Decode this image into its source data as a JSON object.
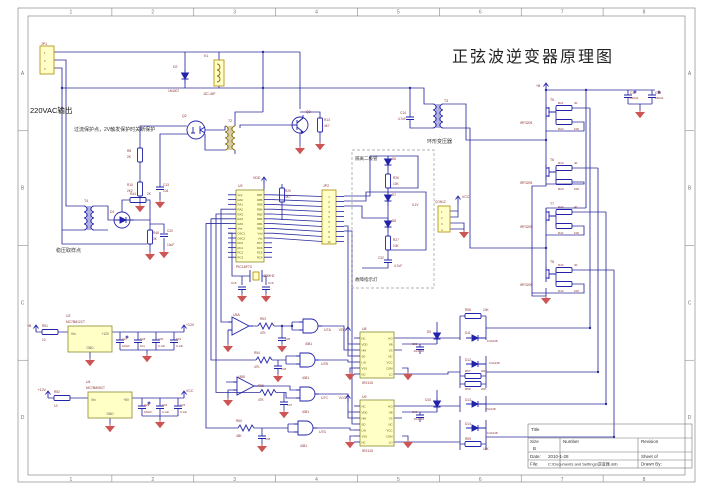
{
  "sheet": {
    "title": "正弦波逆变器原理图"
  },
  "grid": {
    "cols": [
      "1",
      "2",
      "3",
      "4",
      "5",
      "6",
      "7",
      "8"
    ],
    "rows": [
      "A",
      "B",
      "C",
      "D"
    ]
  },
  "mcu": {
    "designator": "U3",
    "part": "PIC16F73",
    "left_pins": [
      "Vpp",
      "RA0",
      "RA1",
      "RA2",
      "RA3",
      "RA4",
      "RA5",
      "Vss",
      "OSC1",
      "OSC2",
      "RC0",
      "RC1",
      "RC2",
      "RC3"
    ],
    "right_pins": [
      "RB7",
      "RB6",
      "RB5",
      "RB4",
      "RB3",
      "RB2",
      "RB1",
      "RB0",
      "Vdd",
      "Vss",
      "RC7",
      "RC6",
      "RC5",
      "RC4"
    ]
  },
  "jp2": {
    "pins": [
      "1",
      "2",
      "3",
      "4",
      "5",
      "6",
      "7",
      "8",
      "9",
      "10"
    ]
  },
  "drivers": {
    "left_pins": [
      "NC",
      "VDD",
      "HIN",
      "SD",
      "LIN",
      "VSS",
      "NC"
    ],
    "right_pins": [
      "HO",
      "VB",
      "VS",
      "NC",
      "VCC",
      "COM",
      "LO"
    ]
  },
  "titleblock": {
    "title_label": "Title",
    "size_label": "Size",
    "size_value": "B",
    "number_label": "Number",
    "revision_label": "Revision",
    "date_label": "Date:",
    "date_value": "2010-1-28",
    "sheet_label": "Sheet of",
    "file_label": "File:",
    "file_value": "C:\\Documents and Settings\\逆变器.ddb",
    "drawn_label": "Drawn By:"
  },
  "colors": {
    "wire": "#2b2b9e",
    "ic_fill": "#ffffc6",
    "ground": "#cc5555",
    "label": "#8b2f2f"
  },
  "annotations": [
    {
      "x": 41,
      "y": 45,
      "t": "JP1",
      "s": 3.5
    },
    {
      "x": 44,
      "y": 54,
      "t": "1",
      "s": 2.8,
      "c": "#555"
    },
    {
      "x": 44,
      "y": 62,
      "t": "2",
      "s": 2.8,
      "c": "#555"
    },
    {
      "x": 44,
      "y": 70,
      "t": "3",
      "s": 2.8,
      "c": "#555"
    },
    {
      "x": 30,
      "y": 113,
      "t": "220VAC输出",
      "s": 7.5,
      "c": "#111"
    },
    {
      "x": 74,
      "y": 131,
      "t": "过流保护点，2V触发保护时关断保护",
      "s": 5,
      "c": "#333"
    },
    {
      "x": 204,
      "y": 57,
      "t": "K1",
      "s": 3.5
    },
    {
      "x": 203,
      "y": 95,
      "t": "JZC-49F",
      "s": 3.2
    },
    {
      "x": 173,
      "y": 68,
      "t": "D2",
      "s": 3.5
    },
    {
      "x": 168,
      "y": 92,
      "t": "1N4007",
      "s": 3.2
    },
    {
      "x": 306,
      "y": 113,
      "t": "Q3",
      "s": 3.5
    },
    {
      "x": 324,
      "y": 121,
      "t": "R13",
      "s": 3.2
    },
    {
      "x": 324,
      "y": 127,
      "t": "4K7",
      "s": 3.2
    },
    {
      "x": 182,
      "y": 117,
      "t": "Q2",
      "s": 3.5
    },
    {
      "x": 228,
      "y": 122,
      "t": "T2",
      "s": 3.5
    },
    {
      "x": 127,
      "y": 152,
      "t": "R8",
      "s": 3.2
    },
    {
      "x": 127,
      "y": 158,
      "t": "2K",
      "s": 3.2
    },
    {
      "x": 127,
      "y": 186,
      "t": "R10",
      "s": 3.2
    },
    {
      "x": 127,
      "y": 192,
      "t": "2K2",
      "s": 3.2
    },
    {
      "x": 163,
      "y": 186,
      "t": "C13",
      "s": 3.2
    },
    {
      "x": 163,
      "y": 192,
      "t": "104",
      "s": 3.2
    },
    {
      "x": 84,
      "y": 202,
      "t": "T4",
      "s": 3.5
    },
    {
      "x": 110,
      "y": 213,
      "t": "D1",
      "s": 3.5
    },
    {
      "x": 130,
      "y": 195,
      "t": "R44",
      "s": 3.2
    },
    {
      "x": 147,
      "y": 195,
      "t": "2K",
      "s": 3.2
    },
    {
      "x": 153,
      "y": 234,
      "t": "R46",
      "s": 3.2
    },
    {
      "x": 153,
      "y": 240,
      "t": "3K",
      "s": 3.2
    },
    {
      "x": 167,
      "y": 232,
      "t": "C20",
      "s": 3.2
    },
    {
      "x": 167,
      "y": 246,
      "t": "10uF",
      "s": 3.2
    },
    {
      "x": 56,
      "y": 252,
      "t": "稳压取样点",
      "s": 5,
      "c": "#333"
    },
    {
      "x": 253,
      "y": 179,
      "t": "VDD",
      "s": 3.5
    },
    {
      "x": 285,
      "y": 192,
      "t": "R20",
      "s": 3.2
    },
    {
      "x": 285,
      "y": 198,
      "t": "4K7",
      "s": 3.2
    },
    {
      "x": 238,
      "y": 187,
      "t": "U3",
      "s": 3.5
    },
    {
      "x": 236,
      "y": 268,
      "t": "PIC16F73",
      "s": 3.5
    },
    {
      "x": 264,
      "y": 277,
      "t": "20MHZ",
      "s": 3.2
    },
    {
      "x": 231,
      "y": 284,
      "t": "C15",
      "s": 3
    },
    {
      "x": 268,
      "y": 284,
      "t": "C16",
      "s": 3
    },
    {
      "x": 323,
      "y": 187,
      "t": "JP2",
      "s": 3.5
    },
    {
      "x": 355,
      "y": 160,
      "t": "隔离二极管",
      "s": 4.5,
      "c": "#333"
    },
    {
      "x": 392,
      "y": 160,
      "t": "D6",
      "s": 3.2
    },
    {
      "x": 393,
      "y": 179,
      "t": "R26",
      "s": 3.2
    },
    {
      "x": 393,
      "y": 185,
      "t": "10K",
      "s": 3.2
    },
    {
      "x": 392,
      "y": 196,
      "t": "D7",
      "s": 3.2
    },
    {
      "x": 412,
      "y": 206,
      "t": "5.1V",
      "s": 3.2
    },
    {
      "x": 392,
      "y": 222,
      "t": "D8",
      "s": 3.2
    },
    {
      "x": 393,
      "y": 241,
      "t": "R27",
      "s": 3.2
    },
    {
      "x": 393,
      "y": 247,
      "t": "10K",
      "s": 3.2
    },
    {
      "x": 378,
      "y": 259,
      "t": "C32",
      "s": 3.2
    },
    {
      "x": 394,
      "y": 267,
      "t": "4.7uF",
      "s": 3.2
    },
    {
      "x": 355,
      "y": 281,
      "t": "故障指示灯",
      "s": 4.5,
      "c": "#333"
    },
    {
      "x": 435,
      "y": 203,
      "t": "CON12",
      "s": 3.2
    },
    {
      "x": 441,
      "y": 213,
      "t": "1",
      "s": 2.8,
      "c": "#555"
    },
    {
      "x": 441,
      "y": 219,
      "t": "2",
      "s": 2.8,
      "c": "#555"
    },
    {
      "x": 441,
      "y": 225,
      "t": "3",
      "s": 2.8,
      "c": "#555"
    },
    {
      "x": 441,
      "y": 231,
      "t": "4",
      "s": 2.8,
      "c": "#555"
    },
    {
      "x": 462,
      "y": 198,
      "t": "VCC",
      "s": 3.5
    },
    {
      "x": 444,
      "y": 102,
      "t": "T3",
      "s": 3.5
    },
    {
      "x": 427,
      "y": 143,
      "t": "环形变压器",
      "s": 5,
      "c": "#333"
    },
    {
      "x": 406,
      "y": 114,
      "t": "C14",
      "s": 3.2,
      "a": "end"
    },
    {
      "x": 406,
      "y": 120,
      "t": "4.7uF",
      "s": 3.2,
      "a": "end"
    },
    {
      "x": 536,
      "y": 87,
      "t": "+B",
      "s": 3.5
    },
    {
      "x": 630,
      "y": 94,
      "t": "C17",
      "s": 3.2
    },
    {
      "x": 630,
      "y": 99,
      "t": "220uF",
      "s": 3
    },
    {
      "x": 655,
      "y": 94,
      "t": "C18",
      "s": 3.2
    },
    {
      "x": 655,
      "y": 99,
      "t": "220uF",
      "s": 3
    },
    {
      "x": 550,
      "y": 101,
      "t": "T5",
      "s": 3.5
    },
    {
      "x": 520,
      "y": 124,
      "t": "IRF3205",
      "s": 3.2
    },
    {
      "x": 558,
      "y": 104,
      "t": "R21",
      "s": 3
    },
    {
      "x": 574,
      "y": 104,
      "t": "40",
      "s": 3
    },
    {
      "x": 558,
      "y": 130,
      "t": "R24",
      "s": 3
    },
    {
      "x": 574,
      "y": 130,
      "t": "10K",
      "s": 3
    },
    {
      "x": 550,
      "y": 161,
      "t": "T6",
      "s": 3.5
    },
    {
      "x": 520,
      "y": 184,
      "t": "IRF3205",
      "s": 3.2
    },
    {
      "x": 558,
      "y": 164,
      "t": "R19",
      "s": 3
    },
    {
      "x": 574,
      "y": 164,
      "t": "40",
      "s": 3
    },
    {
      "x": 558,
      "y": 190,
      "t": "R23",
      "s": 3
    },
    {
      "x": 574,
      "y": 190,
      "t": "10K",
      "s": 3
    },
    {
      "x": 550,
      "y": 205,
      "t": "T7",
      "s": 3.5
    },
    {
      "x": 520,
      "y": 228,
      "t": "IRF3205",
      "s": 3.2
    },
    {
      "x": 558,
      "y": 208,
      "t": "R40",
      "s": 3
    },
    {
      "x": 574,
      "y": 208,
      "t": "40",
      "s": 3
    },
    {
      "x": 558,
      "y": 234,
      "t": "R41",
      "s": 3
    },
    {
      "x": 574,
      "y": 234,
      "t": "10K",
      "s": 3
    },
    {
      "x": 550,
      "y": 263,
      "t": "T8",
      "s": 3.5
    },
    {
      "x": 520,
      "y": 286,
      "t": "IRF3205",
      "s": 3.2
    },
    {
      "x": 558,
      "y": 266,
      "t": "R42",
      "s": 3
    },
    {
      "x": 574,
      "y": 266,
      "t": "40",
      "s": 3
    },
    {
      "x": 558,
      "y": 292,
      "t": "R43",
      "s": 3
    },
    {
      "x": 574,
      "y": 292,
      "t": "10K",
      "s": 3
    },
    {
      "x": 27,
      "y": 327,
      "t": "+B",
      "s": 3.5
    },
    {
      "x": 42,
      "y": 327,
      "t": "R51",
      "s": 3.2
    },
    {
      "x": 42,
      "y": 341,
      "t": "10",
      "s": 3.2
    },
    {
      "x": 66,
      "y": 317,
      "t": "U2",
      "s": 3.5
    },
    {
      "x": 66,
      "y": 323,
      "t": "MC78M12CT",
      "s": 3.2
    },
    {
      "x": 71,
      "y": 335,
      "t": "Vin",
      "s": 3.2,
      "c": "#555"
    },
    {
      "x": 109,
      "y": 335,
      "t": "+12V",
      "s": 3.2,
      "c": "#555",
      "a": "end"
    },
    {
      "x": 90,
      "y": 349,
      "t": "GND",
      "s": 3.2,
      "c": "#555",
      "a": "middle"
    },
    {
      "x": 122,
      "y": 340,
      "t": "C27",
      "s": 2.8
    },
    {
      "x": 122,
      "y": 347,
      "t": "100uF",
      "s": 2.8
    },
    {
      "x": 140,
      "y": 340,
      "t": "C28",
      "s": 2.8
    },
    {
      "x": 140,
      "y": 347,
      "t": "104",
      "s": 2.8
    },
    {
      "x": 158,
      "y": 340,
      "t": "C30",
      "s": 2.8
    },
    {
      "x": 158,
      "y": 347,
      "t": "0.1uF",
      "s": 2.8
    },
    {
      "x": 176,
      "y": 340,
      "t": "C31",
      "s": 2.8
    },
    {
      "x": 176,
      "y": 347,
      "t": "0.1uF",
      "s": 2.8
    },
    {
      "x": 186,
      "y": 326,
      "t": "+12V",
      "s": 3.5
    },
    {
      "x": 46,
      "y": 391,
      "t": "+12V",
      "s": 3.5,
      "a": "end"
    },
    {
      "x": 54,
      "y": 393,
      "t": "R52",
      "s": 3.2
    },
    {
      "x": 54,
      "y": 407,
      "t": "10",
      "s": 3.2
    },
    {
      "x": 86,
      "y": 383,
      "t": "U4",
      "s": 3.5
    },
    {
      "x": 86,
      "y": 389,
      "t": "MC78M05CT",
      "s": 3.2
    },
    {
      "x": 91,
      "y": 401,
      "t": "Vin",
      "s": 3.2,
      "c": "#555"
    },
    {
      "x": 129,
      "y": 401,
      "t": "+5V",
      "s": 3.2,
      "c": "#555",
      "a": "end"
    },
    {
      "x": 110,
      "y": 415,
      "t": "GND",
      "s": 3.2,
      "c": "#555",
      "a": "middle"
    },
    {
      "x": 144,
      "y": 406,
      "t": "C29",
      "s": 2.8
    },
    {
      "x": 144,
      "y": 413,
      "t": "100uF",
      "s": 2.8
    },
    {
      "x": 162,
      "y": 406,
      "t": "C33",
      "s": 2.8
    },
    {
      "x": 162,
      "y": 413,
      "t": "0.1uF",
      "s": 2.8
    },
    {
      "x": 180,
      "y": 406,
      "t": "C34",
      "s": 2.8
    },
    {
      "x": 180,
      "y": 413,
      "t": "0.1uF",
      "s": 2.8
    },
    {
      "x": 186,
      "y": 392,
      "t": "VCC",
      "s": 3.5
    },
    {
      "x": 233,
      "y": 316,
      "t": "U5A",
      "s": 3.5
    },
    {
      "x": 238,
      "y": 378,
      "t": "U5B",
      "s": 3.5
    },
    {
      "x": 260,
      "y": 320,
      "t": "R53",
      "s": 3.2
    },
    {
      "x": 260,
      "y": 334,
      "t": "47K",
      "s": 3.2
    },
    {
      "x": 254,
      "y": 354,
      "t": "R54",
      "s": 3.2
    },
    {
      "x": 254,
      "y": 368,
      "t": "47K",
      "s": 3.2
    },
    {
      "x": 258,
      "y": 387,
      "t": "R55",
      "s": 3.2
    },
    {
      "x": 258,
      "y": 401,
      "t": "47K",
      "s": 3.2
    },
    {
      "x": 236,
      "y": 422,
      "t": "R60",
      "s": 3.2
    },
    {
      "x": 236,
      "y": 437,
      "t": "45K",
      "s": 3.2
    },
    {
      "x": 285,
      "y": 340,
      "t": "C35",
      "s": 2.8
    },
    {
      "x": 281,
      "y": 370,
      "t": "C36",
      "s": 2.8
    },
    {
      "x": 287,
      "y": 406,
      "t": "C37",
      "s": 2.8
    },
    {
      "x": 265,
      "y": 440,
      "t": "C38",
      "s": 2.8
    },
    {
      "x": 324,
      "y": 331,
      "t": "U7A",
      "s": 3.5
    },
    {
      "x": 305,
      "y": 345,
      "t": "4081",
      "s": 3.2
    },
    {
      "x": 321,
      "y": 365,
      "t": "U7B",
      "s": 3.5
    },
    {
      "x": 302,
      "y": 379,
      "t": "4081",
      "s": 3.2
    },
    {
      "x": 321,
      "y": 399,
      "t": "U7C",
      "s": 3.5
    },
    {
      "x": 302,
      "y": 413,
      "t": "4081",
      "s": 3.2
    },
    {
      "x": 319,
      "y": 433,
      "t": "U7D",
      "s": 3.5
    },
    {
      "x": 300,
      "y": 447,
      "t": "4081",
      "s": 3.2
    },
    {
      "x": 346,
      "y": 331,
      "t": "VDD",
      "s": 3.5,
      "a": "end"
    },
    {
      "x": 346,
      "y": 399,
      "t": "VCC",
      "s": 3.5,
      "a": "end"
    },
    {
      "x": 362,
      "y": 330,
      "t": "U8",
      "s": 3.5
    },
    {
      "x": 362,
      "y": 384,
      "t": "IR2110",
      "s": 3.5
    },
    {
      "x": 362,
      "y": 398,
      "t": "U9",
      "s": 3.5
    },
    {
      "x": 362,
      "y": 452,
      "t": "IR2110",
      "s": 3.5
    },
    {
      "x": 431,
      "y": 333,
      "t": "D9",
      "s": 3.2,
      "a": "end"
    },
    {
      "x": 424,
      "y": 352,
      "t": "1N4148",
      "s": 3,
      "a": "end"
    },
    {
      "x": 431,
      "y": 401,
      "t": "D10",
      "s": 3.2,
      "a": "end"
    },
    {
      "x": 424,
      "y": 420,
      "t": "1N4148",
      "s": 3,
      "a": "end"
    },
    {
      "x": 412,
      "y": 345,
      "t": "C39",
      "s": 2.8
    },
    {
      "x": 412,
      "y": 413,
      "t": "C40",
      "s": 2.8
    },
    {
      "x": 465,
      "y": 311,
      "t": "R56",
      "s": 3.2
    },
    {
      "x": 483,
      "y": 311,
      "t": "10K",
      "s": 3.2
    },
    {
      "x": 465,
      "y": 334,
      "t": "D11",
      "s": 3.2
    },
    {
      "x": 487,
      "y": 342,
      "t": "1N4148",
      "s": 3
    },
    {
      "x": 465,
      "y": 361,
      "t": "D12",
      "s": 3.2
    },
    {
      "x": 489,
      "y": 364,
      "t": "1N4148",
      "s": 3
    },
    {
      "x": 465,
      "y": 372,
      "t": "R57",
      "s": 3
    },
    {
      "x": 481,
      "y": 372,
      "t": "20K",
      "s": 3
    },
    {
      "x": 465,
      "y": 390,
      "t": "R58",
      "s": 3
    },
    {
      "x": 481,
      "y": 390,
      "t": "20K",
      "s": 3
    },
    {
      "x": 465,
      "y": 401,
      "t": "D13",
      "s": 3.2
    },
    {
      "x": 485,
      "y": 410,
      "t": "1N4148",
      "s": 3
    },
    {
      "x": 465,
      "y": 425,
      "t": "D14",
      "s": 3.2
    },
    {
      "x": 487,
      "y": 434,
      "t": "1N4148",
      "s": 3
    },
    {
      "x": 465,
      "y": 440,
      "t": "R59",
      "s": 3.2
    },
    {
      "x": 483,
      "y": 450,
      "t": "10K",
      "s": 3.2
    }
  ]
}
